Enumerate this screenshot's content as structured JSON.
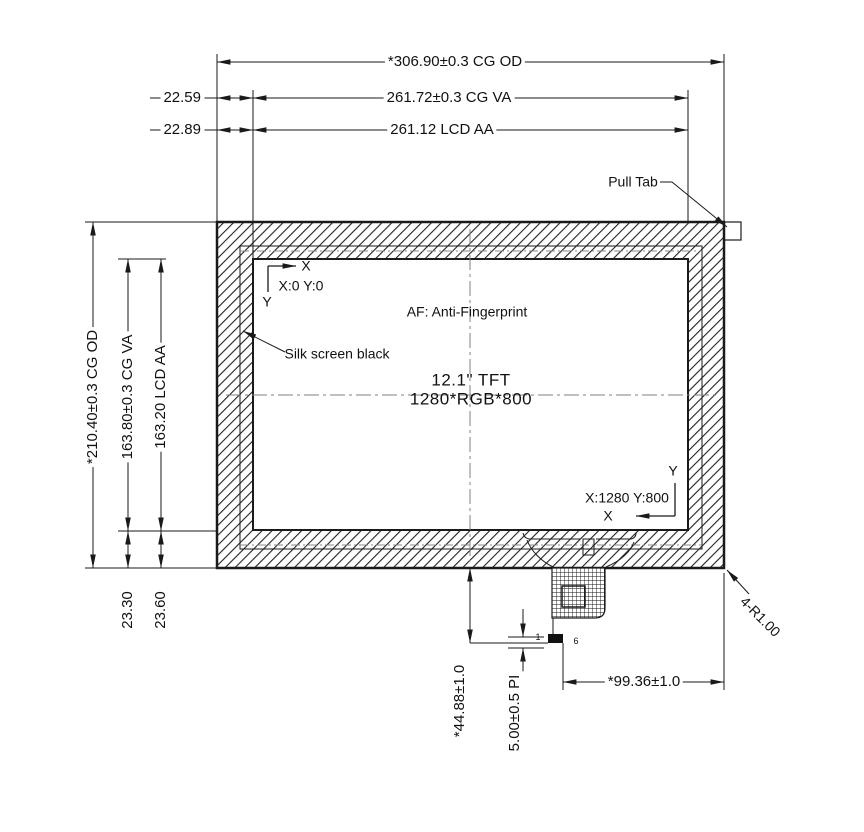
{
  "drawing": {
    "panel_size": "12.1\" TFT",
    "panel_resolution": "1280*RGB*800",
    "af_note": "AF: Anti-Fingerprint",
    "silk_screen_note": "Silk screen black",
    "pull_tab_note": "Pull Tab",
    "corner_radius_note": "4-R1.00",
    "line_color": "#1a1a1a",
    "centerline_color": "#808080"
  },
  "coords": {
    "axis_x": "X",
    "axis_y": "Y",
    "origin": "X:0 Y:0",
    "endpoint": "X:1280 Y:800",
    "pin_first": "1",
    "pin_last": "6"
  },
  "dimensions": {
    "width_cg_od": "*306.90±0.3 CG OD",
    "width_cg_va": "261.72±0.3 CG VA",
    "width_lcd_aa": "261.12 LCD AA",
    "offset_x_cg_va": "22.59",
    "offset_x_lcd_aa": "22.89",
    "height_cg_od": "*210.40±0.3 CG OD",
    "height_cg_va": "163.80±0.3 CG VA",
    "height_lcd_aa": "163.20 LCD AA",
    "offset_y_cg_va": "23.30",
    "offset_y_lcd_aa": "23.60",
    "fpc_drop": "*44.88±1.0",
    "pin_pitch": "5.00±0.5 PI",
    "fpc_offset_x": "*99.36±1.0"
  }
}
